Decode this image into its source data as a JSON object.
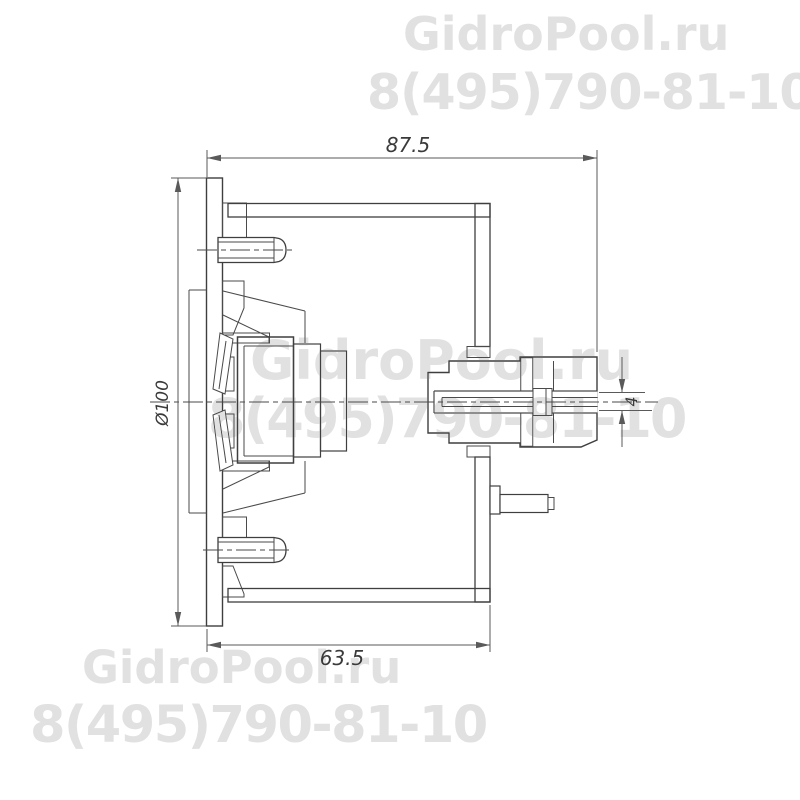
{
  "page": {
    "background": "#ffffff"
  },
  "watermark": {
    "brand": "GidroPool.ru",
    "phone": "8(495)790-81-10",
    "color": "#e1e1e1"
  },
  "drawing": {
    "type": "technical-section-view",
    "subject": "pool wall nozzle fitting cross-section",
    "line_color": "#3f3f3f",
    "dim_color": "#5a5a5a",
    "dimensions": {
      "overall_depth": "87.5",
      "flange_diameter": "Ø100",
      "body_depth": "63.5",
      "nozzle_bore": "4"
    }
  }
}
